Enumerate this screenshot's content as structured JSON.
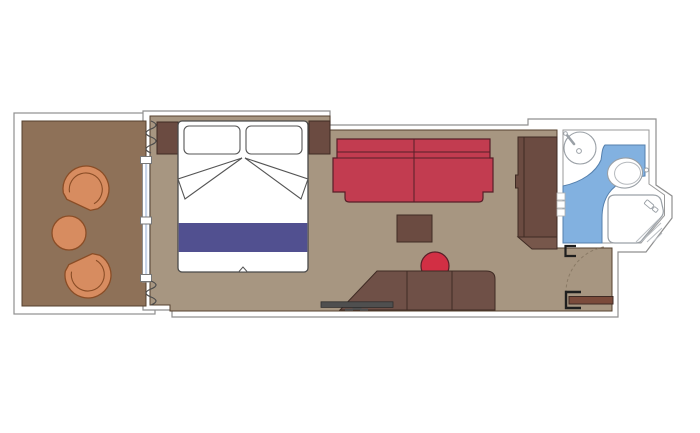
{
  "plan": {
    "type": "cruise-cabin-floor-plan",
    "rooms": [
      "balcony",
      "cabin",
      "bathroom",
      "entry-corridor"
    ],
    "items": [
      "armchair",
      "armchair",
      "round-table",
      "sliding-glass-door",
      "curtain",
      "double-bed",
      "pillow",
      "pillow",
      "bed-runner",
      "nightstand",
      "nightstand",
      "sofa",
      "coffee-table",
      "stool",
      "desk",
      "tv",
      "wardrobe",
      "sink",
      "toilet",
      "shower",
      "shelves",
      "bathroom-door-frame",
      "entry-door",
      "door-swing-arc"
    ]
  },
  "colors": {
    "background": "#ffffff",
    "wall_fill": "#ffffff",
    "wall_line": "#8f8f8f",
    "balcony_floor": "#8e7158",
    "cabin_floor": "#a79681",
    "floor_line": "#54402e",
    "dark_wood": "#6b4b41",
    "wood_base": "#77574b",
    "desk_wood": "#6f5047",
    "door_wood": "#7b4b3b",
    "wood_outline": "#3f2b24",
    "sofa_red": "#c23c50",
    "stool_red": "#d22f44",
    "red_outline": "#571f28",
    "chair_orange": "#d78c60",
    "chair_outline": "#8a4d26",
    "bed_white": "#ffffff",
    "bed_outline": "#4a4a4a",
    "runner_purple": "#515090",
    "glass_blue": "#c5d3e8",
    "bath_floor_blue": "#82b1e0",
    "bath_blue_line": "#5580ad",
    "fixture_white": "#ffffff",
    "fixture_line": "#9aa0a6",
    "hatch_line": "#b9bdc2",
    "tv_gray": "#4f4f4f",
    "swing_line": "#8a7a66",
    "frame_black": "#1f1f1f",
    "curtain_line": "#4a4a4a"
  }
}
